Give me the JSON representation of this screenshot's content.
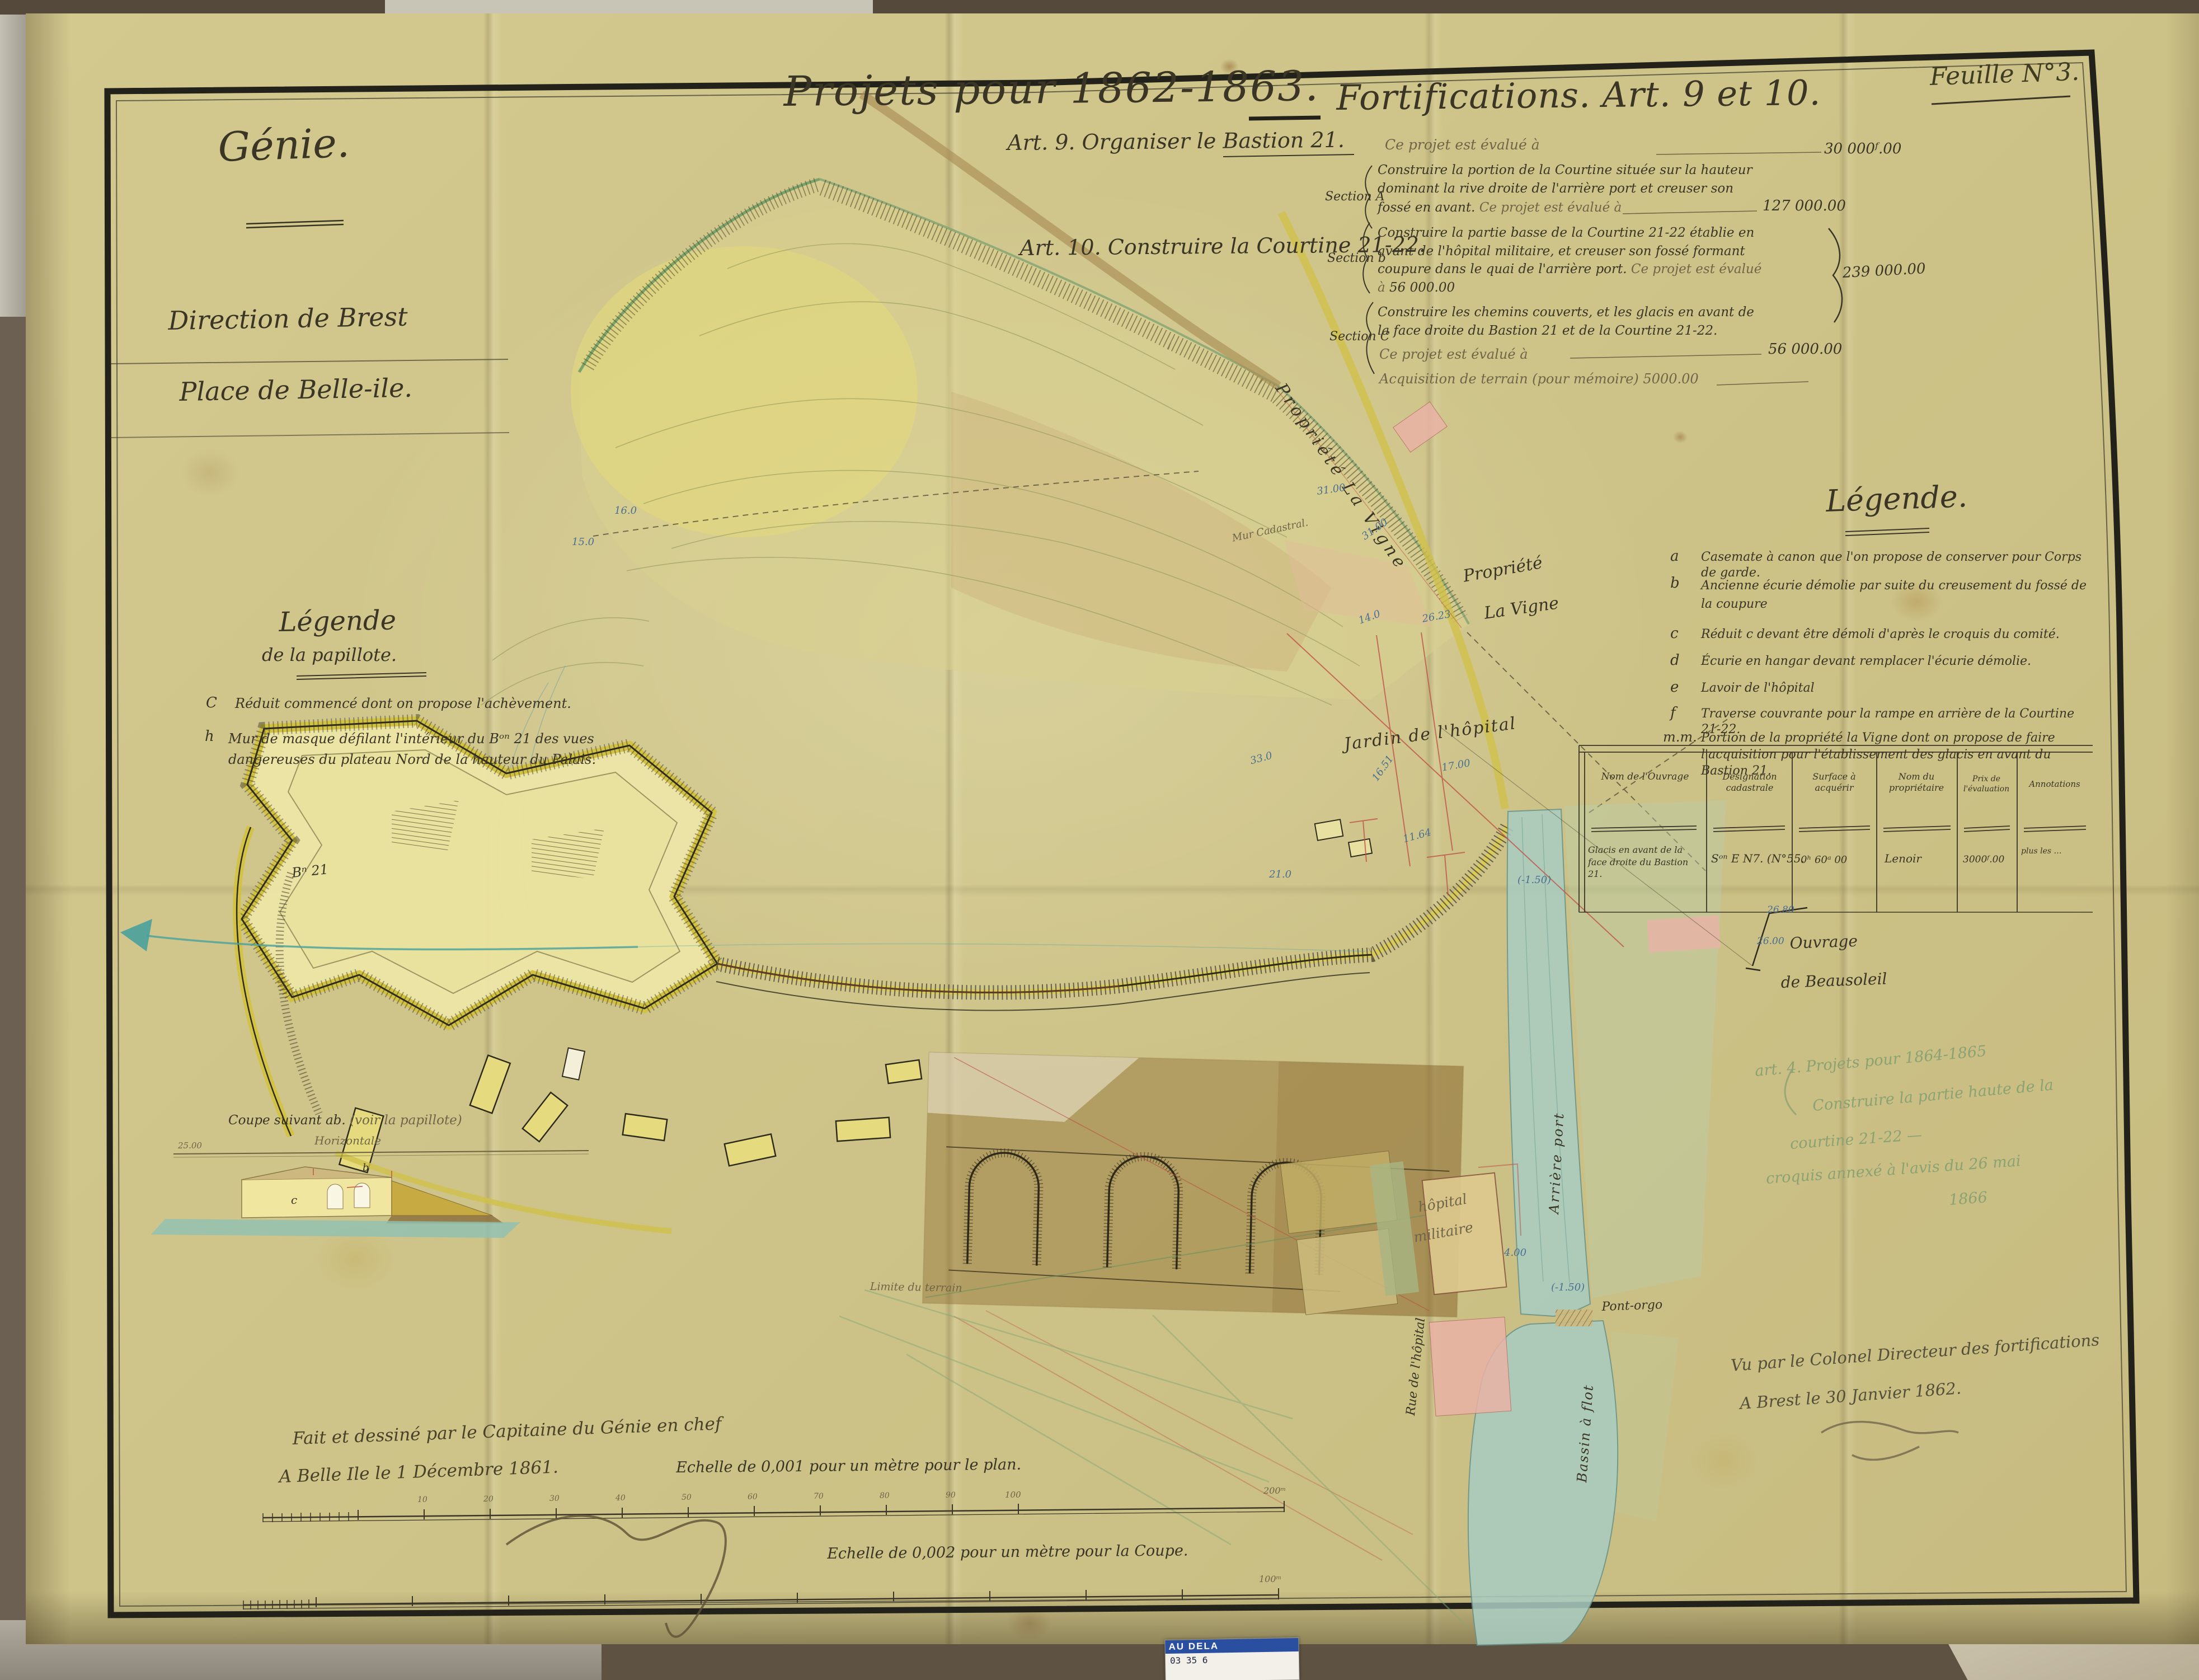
{
  "palette": {
    "paper": "#cec489",
    "ink": "#3a3524",
    "sepia_ink": "#6f6547",
    "blue_note": "#4a6f8f",
    "pencil_green": "#8ba272",
    "water": "#a9cdc3",
    "rampart_yellow": "#d2c23e",
    "flap_brown": "#8f6c30",
    "building_pink": "#e9b3a6"
  },
  "header": {
    "feuille": "Feuille N°3.",
    "org_line1": "Génie.",
    "org_line2": "Direction de Brest",
    "org_line3": "Place de Belle-ile.",
    "title_left": "Projets pour 1862-1863.",
    "title_right": "Fortifications. Art. 9 et 10."
  },
  "art9": {
    "label": "Art. 9. Organiser le Bastion 21.",
    "eval_text": "Ce projet est évalué à",
    "amount": "30 000ᶠ.00"
  },
  "art10": {
    "label": "Art. 10. Construire la Courtine 21-22."
  },
  "sections": {
    "a_name": "Section A",
    "a_text": "Construire la portion de la Courtine située sur la hauteur dominant la rive droite de l'arrière port et creuser son fossé en avant.",
    "a_eval": "Ce projet est évalué à",
    "a_amount": "127 000.00",
    "b_name": "Section b",
    "b_text": "Construire la partie basse de la Courtine 21-22 établie en avant de l'hôpital militaire, et creuser son fossé formant coupure dans le quai de l'arrière port.",
    "b_eval": "Ce projet est évalué à",
    "b_amount": "56 000.00",
    "total_amount": "239 000.00",
    "c_name": "Section C",
    "c_text": "Construire les chemins couverts, et les glacis en avant de la face droite du Bastion 21 et de la Courtine 21-22.",
    "c_eval": "Ce projet est évalué à",
    "c_amount": "56 000.00",
    "acquisition": "Acquisition de terrain (pour mémoire) 5000.00"
  },
  "legend_right": {
    "title": "Légende.",
    "items": [
      {
        "key": "a",
        "text": "Casemate à canon que l'on propose de conserver pour Corps de garde."
      },
      {
        "key": "b",
        "text": "Ancienne écurie démolie par suite du creusement du fossé de la coupure"
      },
      {
        "key": "c",
        "text": "Réduit c devant être démoli d'après le croquis du comité."
      },
      {
        "key": "d",
        "text": "Écurie en hangar devant remplacer l'écurie démolie."
      },
      {
        "key": "e",
        "text": "Lavoir de l'hôpital"
      },
      {
        "key": "f",
        "text": "Traverse couvrante pour la rampe en arrière de la Courtine 21-22."
      },
      {
        "key": "m.m.",
        "text": "Portion de la propriété la Vigne dont on propose de faire l'acquisition pour l'établissement des glacis en avant du Bastion 21."
      }
    ]
  },
  "legend_papillote": {
    "title": "Légende",
    "subtitle": "de la papillote.",
    "items": [
      {
        "key": "C",
        "text": "Réduit commencé dont on propose l'achèvement."
      },
      {
        "key": "h",
        "text": "Mur de masque défilant l'intérieur du Bᵒⁿ 21 des vues dangereuses du plateau Nord de la hauteur du Palais."
      }
    ]
  },
  "table": {
    "headers": [
      "Nom de l'Ouvrage",
      "Désignation cadastrale",
      "Surface à acquérir",
      "Nom du propriétaire",
      "Prix de l'évaluation",
      "Annotations"
    ],
    "row": [
      "Glacis en avant de la face droite du Bastion 21.",
      "Sᵒⁿ E N7. (N°55.",
      "0ʰ 60ᵃ 00",
      "Lenoir",
      "3000ᶠ.00",
      "plus les …"
    ]
  },
  "map": {
    "labels": {
      "propriete_vigne_road": "Propriété La Vigne",
      "propriete_vigne": "Propriété",
      "propriete_vigne2": "La Vigne",
      "jardin": "Jardin de l'hôpital",
      "hopital1": "hôpital",
      "hopital2": "militaire",
      "rue": "Rue de l'hôpital",
      "arriere_port": "Arrière port",
      "bassin": "Bassin à flot",
      "pont": "Pont-orgo",
      "ouvrage1": "Ouvrage",
      "ouvrage2": "de Beausoleil",
      "mur": "Mur Cadastral.",
      "bastion": "Bⁿ 21",
      "limite": "Limite du terrain"
    },
    "spot_heights": [
      "31.00",
      "31.00",
      "26.23",
      "16.51",
      "17.00",
      "11.64",
      "14.0",
      "21.0",
      "33.0",
      "16.0",
      "15.0",
      "(-1.50)",
      "(-1.50)",
      "4.00",
      "26.00",
      "26.80"
    ]
  },
  "coupe": {
    "title": "Coupe suivant ab.",
    "title2": "(voir la papillote)",
    "axis": "Horizontale",
    "ref": "25.00",
    "letter_c": "c",
    "letter_b": "b"
  },
  "scales": {
    "plan_text": "Echelle de 0,001 pour un mètre pour le plan.",
    "coupe_text": "Echelle de 0,002 pour un mètre pour la Coupe.",
    "plan_ticks": [
      "10",
      "20",
      "30",
      "40",
      "50",
      "60",
      "70",
      "80",
      "90",
      "100",
      "200ᵐ"
    ],
    "coupe_end": "100ᵐ"
  },
  "signatures": {
    "made_line1": "Fait et dessiné par le Capitaine du Génie en chef",
    "made_line2": "A Belle Ile le 1 Décembre 1861.",
    "seen_line1": "Vu par le Colonel Directeur des fortifications",
    "seen_line2": "A Brest le 30 Janvier 1862."
  },
  "pencil_note": {
    "line1": "art. 4. Projets pour 1864-1865",
    "line2": "Construire la partie haute de la",
    "line3": "courtine 21-22 —",
    "line4": "croquis annexé à l'avis du 26 mai",
    "line5": "1866"
  },
  "photo": {
    "sticker": {
      "line1": "AU DELA",
      "line2": "03 35 6"
    }
  }
}
